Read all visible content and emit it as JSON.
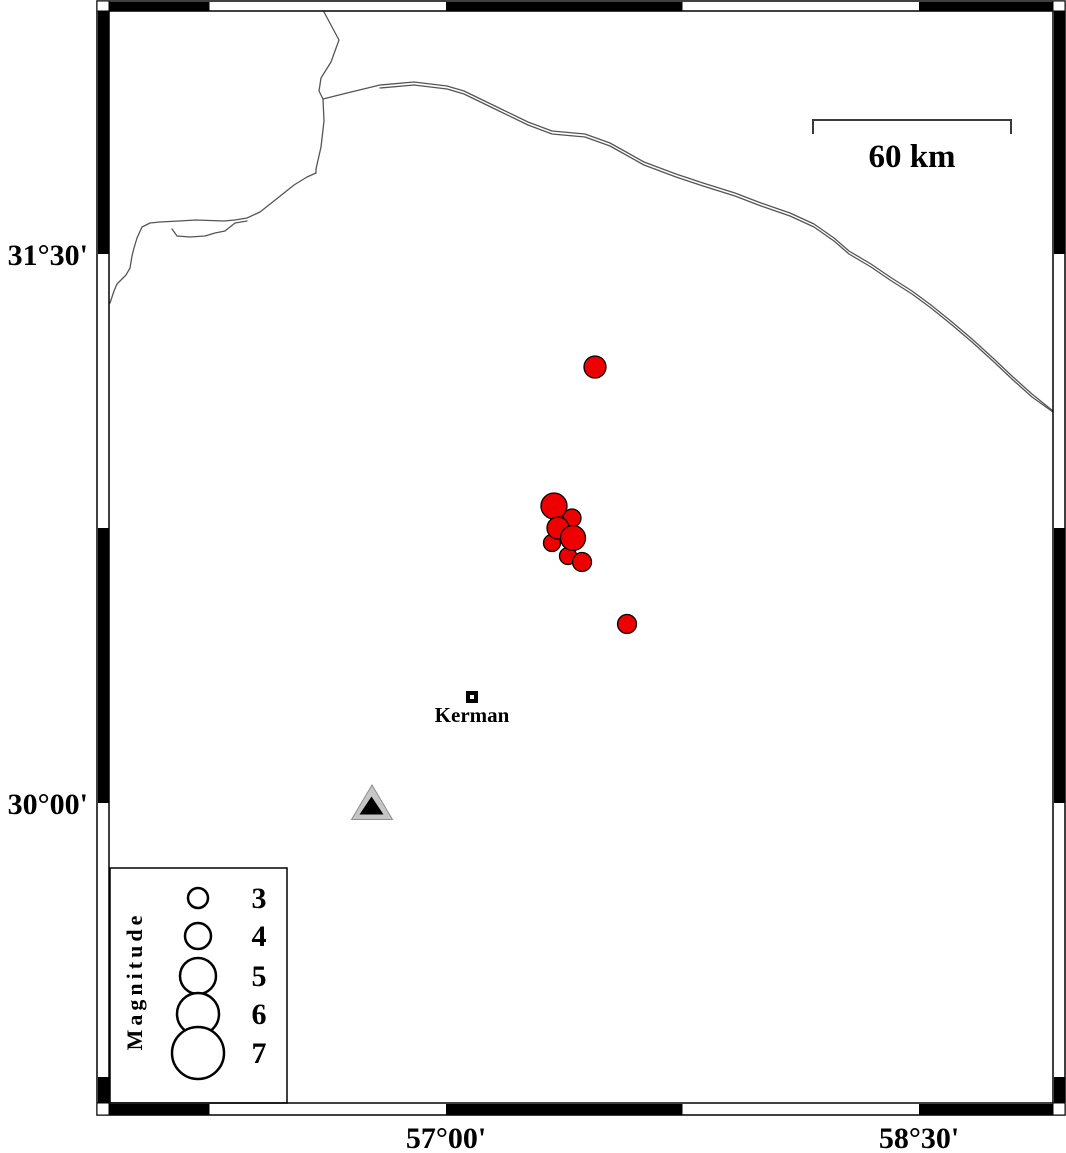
{
  "map": {
    "latitude_labels": [
      {
        "text": "31°30'",
        "y": 254
      },
      {
        "text": "30°00'",
        "y": 803
      }
    ],
    "longitude_labels": [
      {
        "text": "57°00'",
        "x": 446
      },
      {
        "text": "58°30'",
        "x": 919
      }
    ],
    "scale_bar": {
      "label": "60 km"
    },
    "city": {
      "name": "Kerman",
      "x": 472,
      "y": 697
    },
    "station": {
      "symbol": "triangle",
      "x": 372,
      "y": 805
    },
    "earthquakes": [
      {
        "x": 595,
        "y": 367,
        "r": 11
      },
      {
        "x": 572,
        "y": 518,
        "r": 9
      },
      {
        "x": 554,
        "y": 506,
        "r": 13
      },
      {
        "x": 552,
        "y": 543,
        "r": 8.5
      },
      {
        "x": 558,
        "y": 528,
        "r": 11
      },
      {
        "x": 568,
        "y": 556,
        "r": 8.5
      },
      {
        "x": 573,
        "y": 538,
        "r": 12.5
      },
      {
        "x": 582,
        "y": 562,
        "r": 9.5
      },
      {
        "x": 627,
        "y": 624,
        "r": 9.5
      }
    ]
  },
  "legend": {
    "title": "Magnitude",
    "symbol_x": 198,
    "label_x": 259,
    "items": [
      {
        "magnitude": "3",
        "y": 898,
        "r": 10
      },
      {
        "magnitude": "4",
        "y": 936,
        "r": 13
      },
      {
        "magnitude": "5",
        "y": 976,
        "r": 18
      },
      {
        "magnitude": "6",
        "y": 1014,
        "r": 21
      },
      {
        "magnitude": "7",
        "y": 1053,
        "r": 26
      }
    ]
  },
  "colors": {
    "epicenter": "#ee0000",
    "epicenter_outline": "#000000",
    "station_fill": "#c6c6c6",
    "station_outline": "#8e8e8e",
    "station_inner": "#000000",
    "map_line": "#555555",
    "frame": "#000000"
  }
}
